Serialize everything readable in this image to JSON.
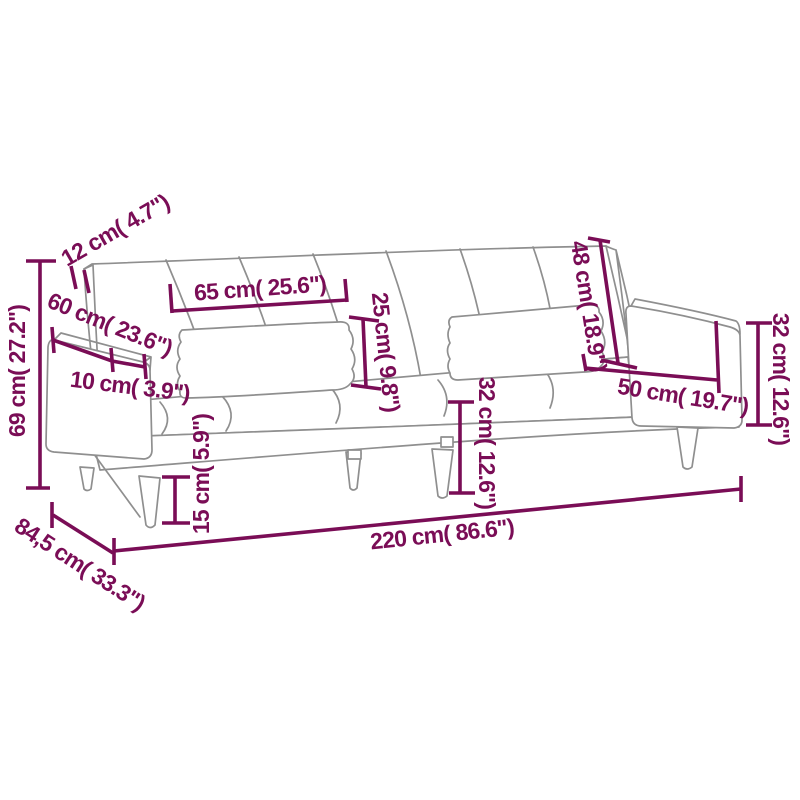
{
  "diagram": {
    "type": "furniture-dimension-drawing",
    "subject": "sofa-bed line drawing with measurement annotations"
  },
  "colors": {
    "annotation": "#7a0d56",
    "drawing_outline": "#8f8f8f",
    "background": "#ffffff"
  },
  "dimensions": [
    {
      "id": "backrest-thickness",
      "label": "12 cm( 4.7\")"
    },
    {
      "id": "back-cushion-width",
      "label": "65 cm( 25.6\")"
    },
    {
      "id": "back-cushion-height",
      "label": "25 cm( 9.8\")"
    },
    {
      "id": "backrest-height",
      "label": "48 cm( 18.9\")"
    },
    {
      "id": "armrest-height",
      "label": "32 cm( 12.6\")"
    },
    {
      "id": "armrest-depth",
      "label": "60 cm( 23.6\")"
    },
    {
      "id": "armrest-top-width",
      "label": "10 cm( 3.9\")"
    },
    {
      "id": "seat-depth",
      "label": "50 cm( 19.7\")"
    },
    {
      "id": "total-height",
      "label": "69 cm( 27.2\")"
    },
    {
      "id": "leg-height",
      "label": "15 cm( 5.9\")"
    },
    {
      "id": "seat-height",
      "label": "32 cm( 12.6\")"
    },
    {
      "id": "total-width",
      "label": "220 cm( 86.6\")"
    },
    {
      "id": "total-depth",
      "label": "84,5 cm( 33.3\")"
    }
  ]
}
